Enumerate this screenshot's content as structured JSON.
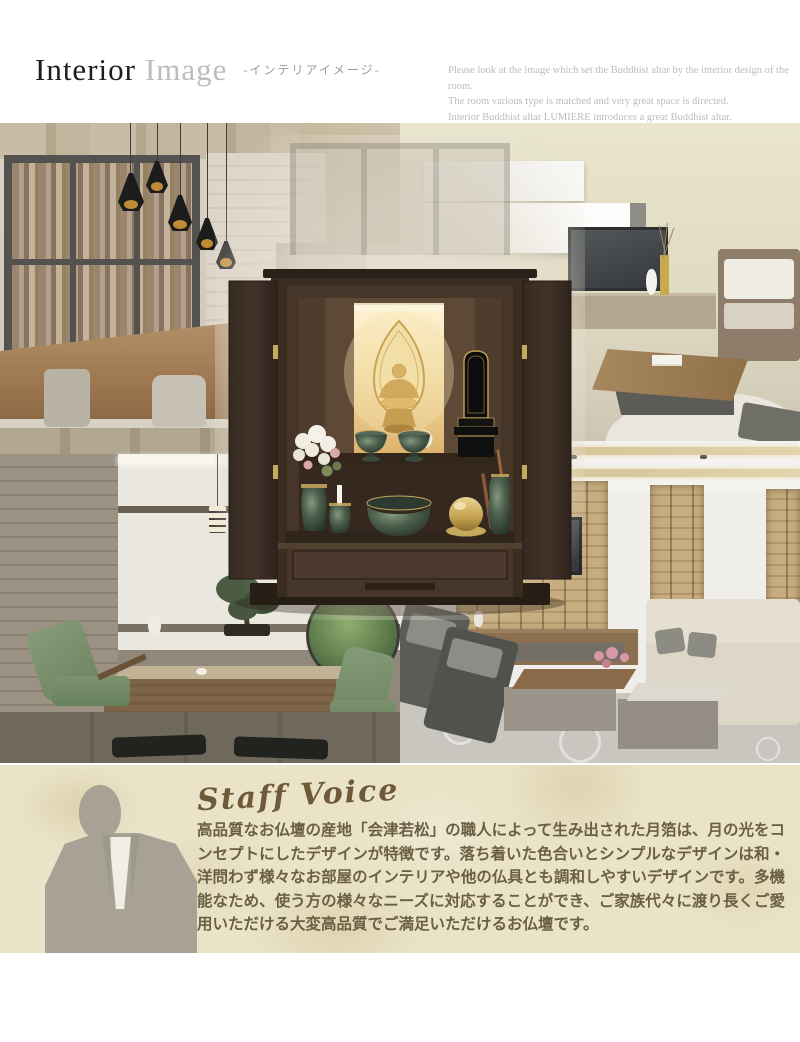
{
  "header": {
    "title_primary": "Interior",
    "title_secondary": "Image",
    "title_jp": "-インテリアイメージ-",
    "intro_lines": [
      "Please look at the image which set the Buddhist altar by the interior design of the room.",
      "The room various type is matched and very great space is directed.",
      "Interior Buddhist altar LUMIERE introduces a great Buddhist altar."
    ]
  },
  "collage": {
    "scenes": {
      "top_left": "wooden cabin dining room with forest view windows and black pendant lamps",
      "top_right": "modern living room with white wall cabinets, TV and wooden sofa",
      "bottom_left": "japanese tatami room with bonsai, lanterns, green armchairs and round garden window",
      "bottom_right": "stone wall living room with beige sofa, TV console and patterned rug",
      "center": "dark brown Buddhist altar LUMIERE with open doors, backlit golden Buddha statue, memorial tablet and green altar vessels"
    }
  },
  "staff_voice": {
    "heading": "Staff Voice",
    "body": "高品質なお仏壇の産地「会津若松」の職人によって生み出された月箔は、月の光をコンセプトにしたデザインが特徴です。落ち着いた色合いとシンプルなデザインは和・洋問わず様々なお部屋のインテリアや他の仏具とも調和しやすいデザインです。多機能なため、使う方の様々なニーズに対応することができ、ご家族代々に渡り長くご愛用いただける大変高品質でご満足いただけるお仏壇です。"
  },
  "colors": {
    "page_background": "#ffffff",
    "title_primary": "#1d1d1d",
    "title_secondary": "#bdbdbd",
    "intro_text": "#bcbcbc",
    "staff_background": "#eae3c8",
    "staff_heading": "#6e5939",
    "staff_text": "#6a5f45",
    "altar_wood": "#46362a",
    "altar_glow": "#f3dda6",
    "vessel_green": "#4c5f4c"
  }
}
